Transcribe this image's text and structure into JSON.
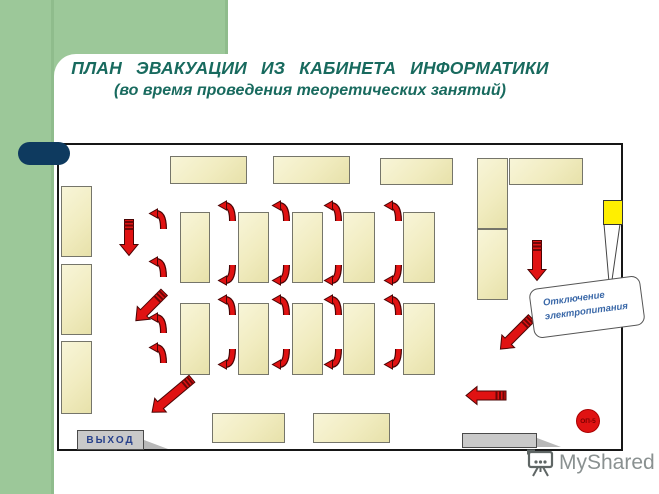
{
  "title": {
    "line1": "ПЛАН  ЭВАКУАЦИИ  ИЗ  КАБИНЕТА  ИНФОРМАТИКИ",
    "line2": "(во время проведения теоретических занятий)"
  },
  "room": {
    "callout": {
      "line1": "Отключение",
      "line2": "электропитания"
    },
    "extinguisher_label": "ОП-5"
  },
  "watermark": {
    "text": "MyShared"
  },
  "colors": {
    "accent_green": "#9cc899",
    "accent_navy": "#0e3a5f",
    "title_teal": "#186a5e",
    "desk_fill": "#f1ecc0",
    "arrow_red": "#e01212",
    "panel_yellow": "#ffef00",
    "door_gray": "#c9c9c9",
    "callout_text_blue": "#3a68a8"
  },
  "layout": {
    "desks": [
      {
        "x": 61,
        "y": 186,
        "w": 31,
        "h": 71
      },
      {
        "x": 61,
        "y": 264,
        "w": 31,
        "h": 71
      },
      {
        "x": 61,
        "y": 341,
        "w": 31,
        "h": 73
      },
      {
        "x": 170,
        "y": 156,
        "w": 77,
        "h": 28
      },
      {
        "x": 273,
        "y": 156,
        "w": 77,
        "h": 28
      },
      {
        "x": 380,
        "y": 158,
        "w": 73,
        "h": 27
      },
      {
        "x": 477,
        "y": 158,
        "w": 31,
        "h": 71
      },
      {
        "x": 477,
        "y": 229,
        "w": 31,
        "h": 71
      },
      {
        "x": 509,
        "y": 158,
        "w": 74,
        "h": 27
      },
      {
        "x": 180,
        "y": 212,
        "w": 30,
        "h": 71
      },
      {
        "x": 238,
        "y": 212,
        "w": 31,
        "h": 71
      },
      {
        "x": 292,
        "y": 212,
        "w": 31,
        "h": 71
      },
      {
        "x": 343,
        "y": 212,
        "w": 32,
        "h": 71
      },
      {
        "x": 403,
        "y": 212,
        "w": 32,
        "h": 71
      },
      {
        "x": 180,
        "y": 303,
        "w": 30,
        "h": 72
      },
      {
        "x": 238,
        "y": 303,
        "w": 31,
        "h": 72
      },
      {
        "x": 292,
        "y": 303,
        "w": 31,
        "h": 72
      },
      {
        "x": 343,
        "y": 303,
        "w": 32,
        "h": 72
      },
      {
        "x": 403,
        "y": 303,
        "w": 32,
        "h": 72
      },
      {
        "x": 212,
        "y": 413,
        "w": 73,
        "h": 30
      },
      {
        "x": 313,
        "y": 413,
        "w": 77,
        "h": 30
      }
    ],
    "doors": [
      {
        "x": 77,
        "y": 430,
        "w": 67,
        "h": 20,
        "label": "ВЫХОД"
      },
      {
        "x": 462,
        "y": 433,
        "w": 75,
        "h": 15,
        "label": ""
      }
    ],
    "straight_arrows": [
      {
        "cx": 129,
        "cy": 237,
        "len": 38,
        "angle": 90
      },
      {
        "cx": 150,
        "cy": 306,
        "len": 42,
        "angle": 135
      },
      {
        "cx": 172,
        "cy": 395,
        "len": 54,
        "angle": 140
      },
      {
        "cx": 537,
        "cy": 260,
        "len": 42,
        "angle": 90
      },
      {
        "cx": 516,
        "cy": 333,
        "len": 46,
        "angle": 135
      },
      {
        "cx": 486,
        "cy": 395,
        "len": 42,
        "angle": 180
      }
    ],
    "curved_arrows": [
      {
        "x": 149,
        "y": 208,
        "dir": "up"
      },
      {
        "x": 149,
        "y": 256,
        "dir": "up"
      },
      {
        "x": 149,
        "y": 312,
        "dir": "up"
      },
      {
        "x": 149,
        "y": 342,
        "dir": "up"
      },
      {
        "x": 218,
        "y": 200,
        "dir": "up"
      },
      {
        "x": 272,
        "y": 200,
        "dir": "up"
      },
      {
        "x": 324,
        "y": 200,
        "dir": "up"
      },
      {
        "x": 384,
        "y": 200,
        "dir": "up"
      },
      {
        "x": 218,
        "y": 264,
        "dir": "down"
      },
      {
        "x": 272,
        "y": 264,
        "dir": "down"
      },
      {
        "x": 324,
        "y": 264,
        "dir": "down"
      },
      {
        "x": 384,
        "y": 264,
        "dir": "down"
      },
      {
        "x": 218,
        "y": 294,
        "dir": "up"
      },
      {
        "x": 272,
        "y": 294,
        "dir": "up"
      },
      {
        "x": 324,
        "y": 294,
        "dir": "up"
      },
      {
        "x": 384,
        "y": 294,
        "dir": "up"
      },
      {
        "x": 218,
        "y": 348,
        "dir": "down"
      },
      {
        "x": 272,
        "y": 348,
        "dir": "down"
      },
      {
        "x": 324,
        "y": 348,
        "dir": "down"
      },
      {
        "x": 384,
        "y": 348,
        "dir": "down"
      }
    ]
  }
}
